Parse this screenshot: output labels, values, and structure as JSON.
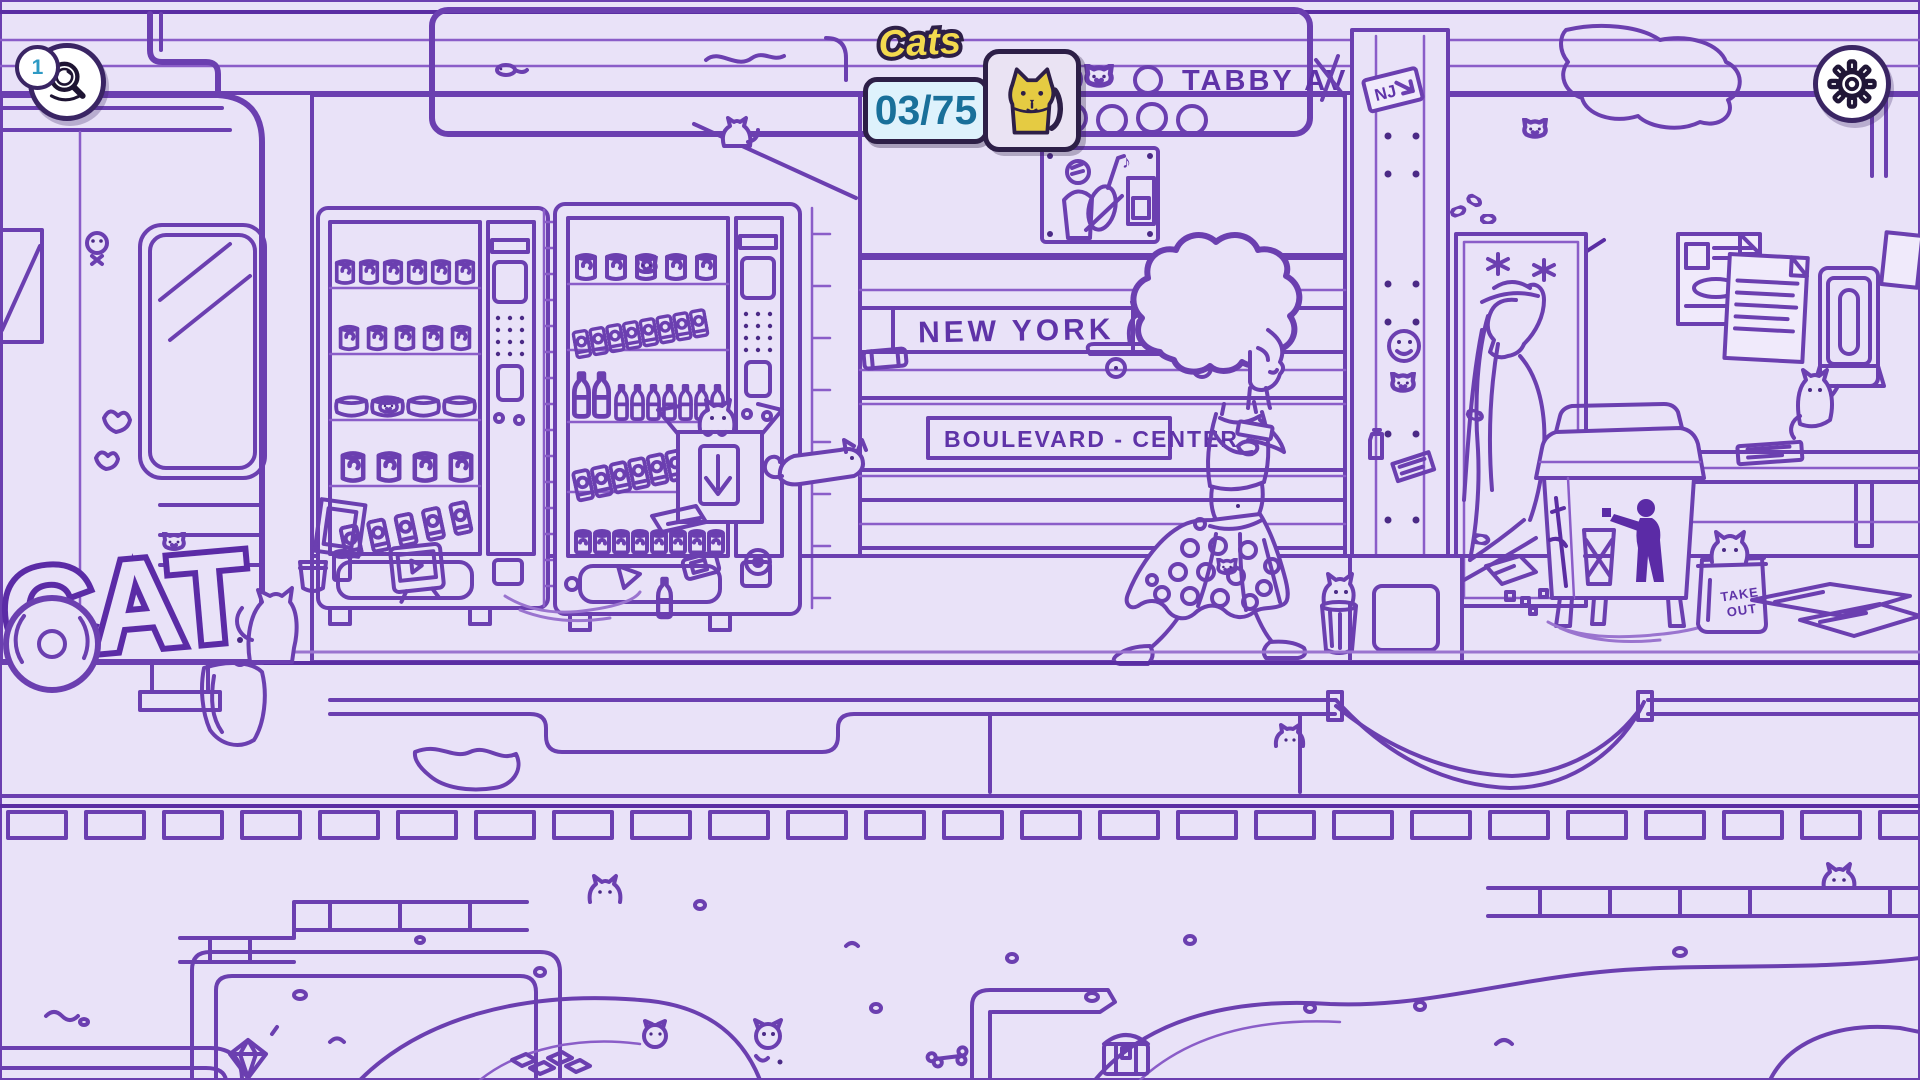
{
  "hud": {
    "hint_button": {
      "badge": "1",
      "icon": "magnifier"
    },
    "cat_counter": {
      "label": "Cats",
      "value": "03/75",
      "found": 3,
      "total": 75
    },
    "settings_button": {
      "icon": "gear"
    }
  },
  "scene": {
    "station_sign": "TABBY AVE.",
    "bench_graffiti": "NEW YORK",
    "station_board": "BOULEVARD - CENTER",
    "train_graffiti": "CAT",
    "pillar_sticker": "NJ",
    "takeout_bag": {
      "line1": "TAKE",
      "line2": "OUT"
    }
  },
  "colors": {
    "background": "#e9e2f8",
    "ink": "#6b3fb0",
    "ink_dark": "#5b2ba6",
    "ui_border": "#2d1f47",
    "counter_bg": "#def2fc",
    "counter_text": "#19709a",
    "label_yellow": "#f3da4e",
    "cat_yellow": "#e5cb42",
    "found_cat_cyan": "#35c9e9",
    "badge_number": "#2e9ac4"
  }
}
